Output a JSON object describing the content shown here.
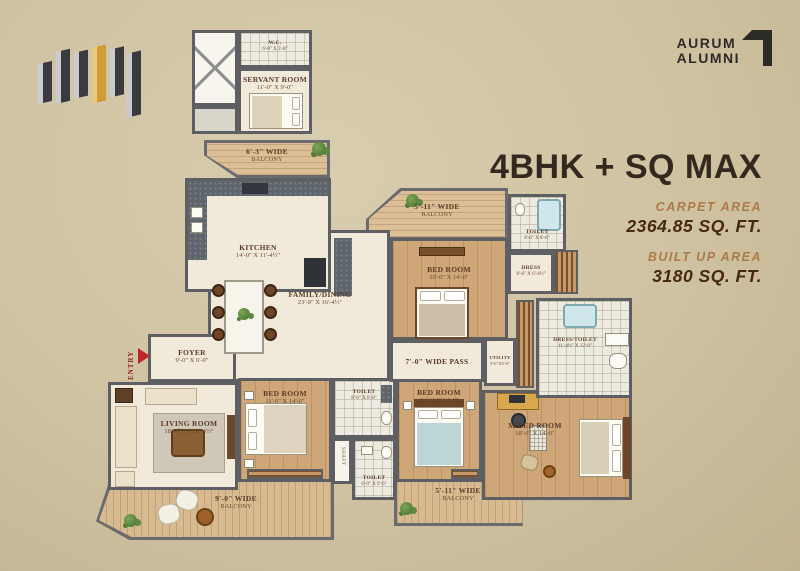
{
  "palette": {
    "background": "#cfc2a1",
    "wall": "#5e5f63",
    "wood_floor": "#cfa678",
    "deck": "#d8ba90",
    "marble": "#f1eadb",
    "accent_red": "#c0272d",
    "title_color": "#33291f",
    "area_label_color": "#ad7a49",
    "area_value_color": "#46290f",
    "plant_green": "#5c8a3e",
    "logo_gold": "#d29c35"
  },
  "branding": {
    "line1": "AURUM",
    "line2": "ALUMNI"
  },
  "header": {
    "title": "4BHK + SQ MAX",
    "carpet_label": "CARPET AREA",
    "carpet_value": "2364.85 SQ. FT.",
    "builtup_label": "BUILT UP AREA",
    "builtup_value": "3180 SQ. FT."
  },
  "plan": {
    "entry": {
      "l1": "ENTRY"
    },
    "shaft": {
      "l1": "SHAFT"
    },
    "wc": {
      "l1": "W.C.",
      "l2": "6'-0\" X 3'-8\""
    },
    "servant": {
      "l1": "SERVANT ROOM",
      "l2": "11'-0\" X 9'-0\""
    },
    "balcony63": {
      "l1": "6'-3\" WIDE",
      "l2": "BALCONY"
    },
    "kitchen": {
      "l1": "KITCHEN",
      "l2": "14'-0\" X 11'-4½\""
    },
    "family": {
      "l1": "FAMILY/DINING",
      "l2": "23'-9\" X 16'-4½\""
    },
    "foyer": {
      "l1": "FOYER",
      "l2": "9'-0\" X 6'-0\""
    },
    "living": {
      "l1": "LIVING ROOM",
      "l2": "18'-4½\" X 20'-4½\""
    },
    "bed1": {
      "l1": "BED ROOM",
      "l2": "11'-0\" X 14'-0\""
    },
    "toilet_mid": {
      "l1": "TOILET",
      "l2": "8'-6\" X 6'-0\""
    },
    "toilet_bottom": {
      "l1": "TOILET",
      "l2": "6'-0\" X 9'-6\""
    },
    "bed2": {
      "l1": "BED ROOM",
      "l2": "11'-6\" X 14'-0\""
    },
    "mbed": {
      "l1": "M.BED ROOM",
      "l2": "18'-0\" X 14'-0\""
    },
    "bed3": {
      "l1": "BED ROOM",
      "l2": "10'-0\" X 14'-0\""
    },
    "balcony_top": {
      "l1": "5'-11\" WIDE",
      "l2": "BALCONY"
    },
    "toilet_top": {
      "l1": "TOILET",
      "l2": "8'-6\" X 8'-6\""
    },
    "dress": {
      "l1": "DRESS",
      "l2": "8'-6\" X 6'-4½\""
    },
    "pass": {
      "l1": "7'-0\" WIDE PASS"
    },
    "utility": {
      "l1": "UTILITY",
      "l2": "3'-6\"X5'-6\""
    },
    "dress_toilet": {
      "l1": "DRESS/TOILET",
      "l2": "11'-4½\" X 12'-0\""
    },
    "balcony_bl": {
      "l1": "9'-0\" WIDE",
      "l2": "BALCONY"
    },
    "balcony_br": {
      "l1": "5'-11\" WIDE",
      "l2": "BALCONY"
    }
  }
}
